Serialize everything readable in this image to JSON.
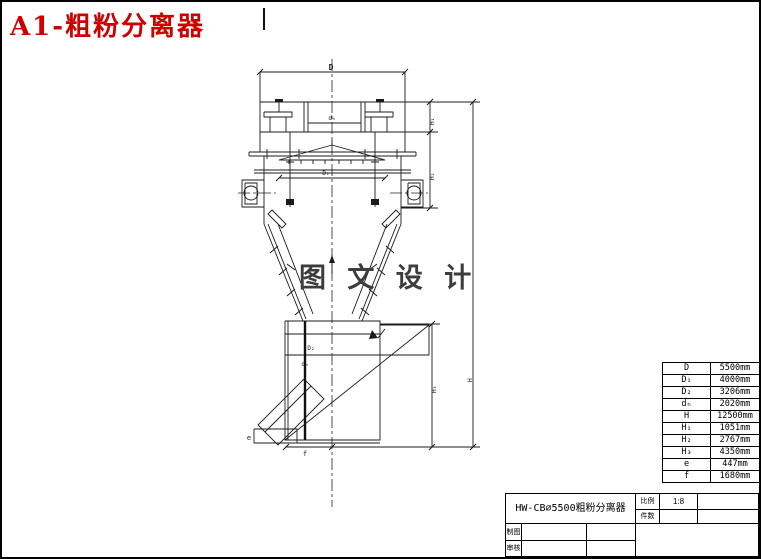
{
  "header": {
    "title": "A1-粗粉分离器",
    "title_color": "#cf0000"
  },
  "watermark": {
    "text": "图 文 设 计"
  },
  "drawing": {
    "labels": {
      "d_top": "D",
      "d_hood": "dₕ",
      "d1": "D₁",
      "d2": "D₂",
      "d_pipe": "dₕ",
      "h": "H",
      "h1": "H₁",
      "h2": "H₂",
      "h3": "H₃",
      "e": "e",
      "f": "f"
    }
  },
  "dimension_table": {
    "rows": [
      {
        "label": "D",
        "value": "5500mm"
      },
      {
        "label": "D₁",
        "value": "4000mm"
      },
      {
        "label": "D₂",
        "value": "3206mm"
      },
      {
        "label": "dₕ",
        "value": "2020mm"
      },
      {
        "label": "H",
        "value": "12500mm"
      },
      {
        "label": "H₁",
        "value": "1051mm"
      },
      {
        "label": "H₂",
        "value": "2767mm"
      },
      {
        "label": "H₃",
        "value": "4350mm"
      },
      {
        "label": "e",
        "value": "447mm"
      },
      {
        "label": "f",
        "value": "1680mm"
      }
    ]
  },
  "title_block": {
    "drawing_title": "HW-CB∅5500粗粉分离器",
    "scale_label": "比例",
    "scale_value": "1:8",
    "quantity_label": "件数",
    "drafter_label": "制图",
    "reviewer_label": "审核"
  }
}
